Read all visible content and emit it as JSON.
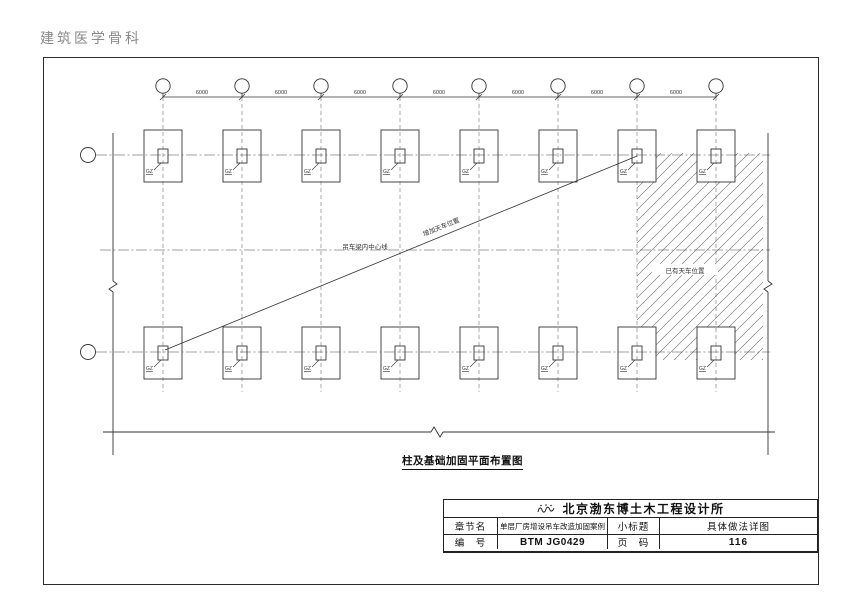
{
  "header": {
    "doc_title": "建筑医学骨科"
  },
  "drawing": {
    "caption": "柱及基础加固平面布置图",
    "dimensions": [
      "6000",
      "6000",
      "6000",
      "6000",
      "6000",
      "6000",
      "6000"
    ],
    "column_tag": "GZ",
    "labels": {
      "crane_beam_centerline": "吊车梁内中心线",
      "added_crane": "增加天车位置",
      "existing_crane": "已有天车位置"
    }
  },
  "title_block": {
    "company": "北京渤东博土木工程设计所",
    "chapter_label": "章节名",
    "chapter_value": "单层厂房增设吊车改造加固案例",
    "subtitle_label": "小标题",
    "subtitle_value": "具体做法详图",
    "number_label": "编　号",
    "number_value": "BTM JG0429",
    "page_label": "页　码",
    "page_value": "116"
  },
  "colors": {
    "ink": "#333333",
    "muted": "#8a8a8a"
  }
}
